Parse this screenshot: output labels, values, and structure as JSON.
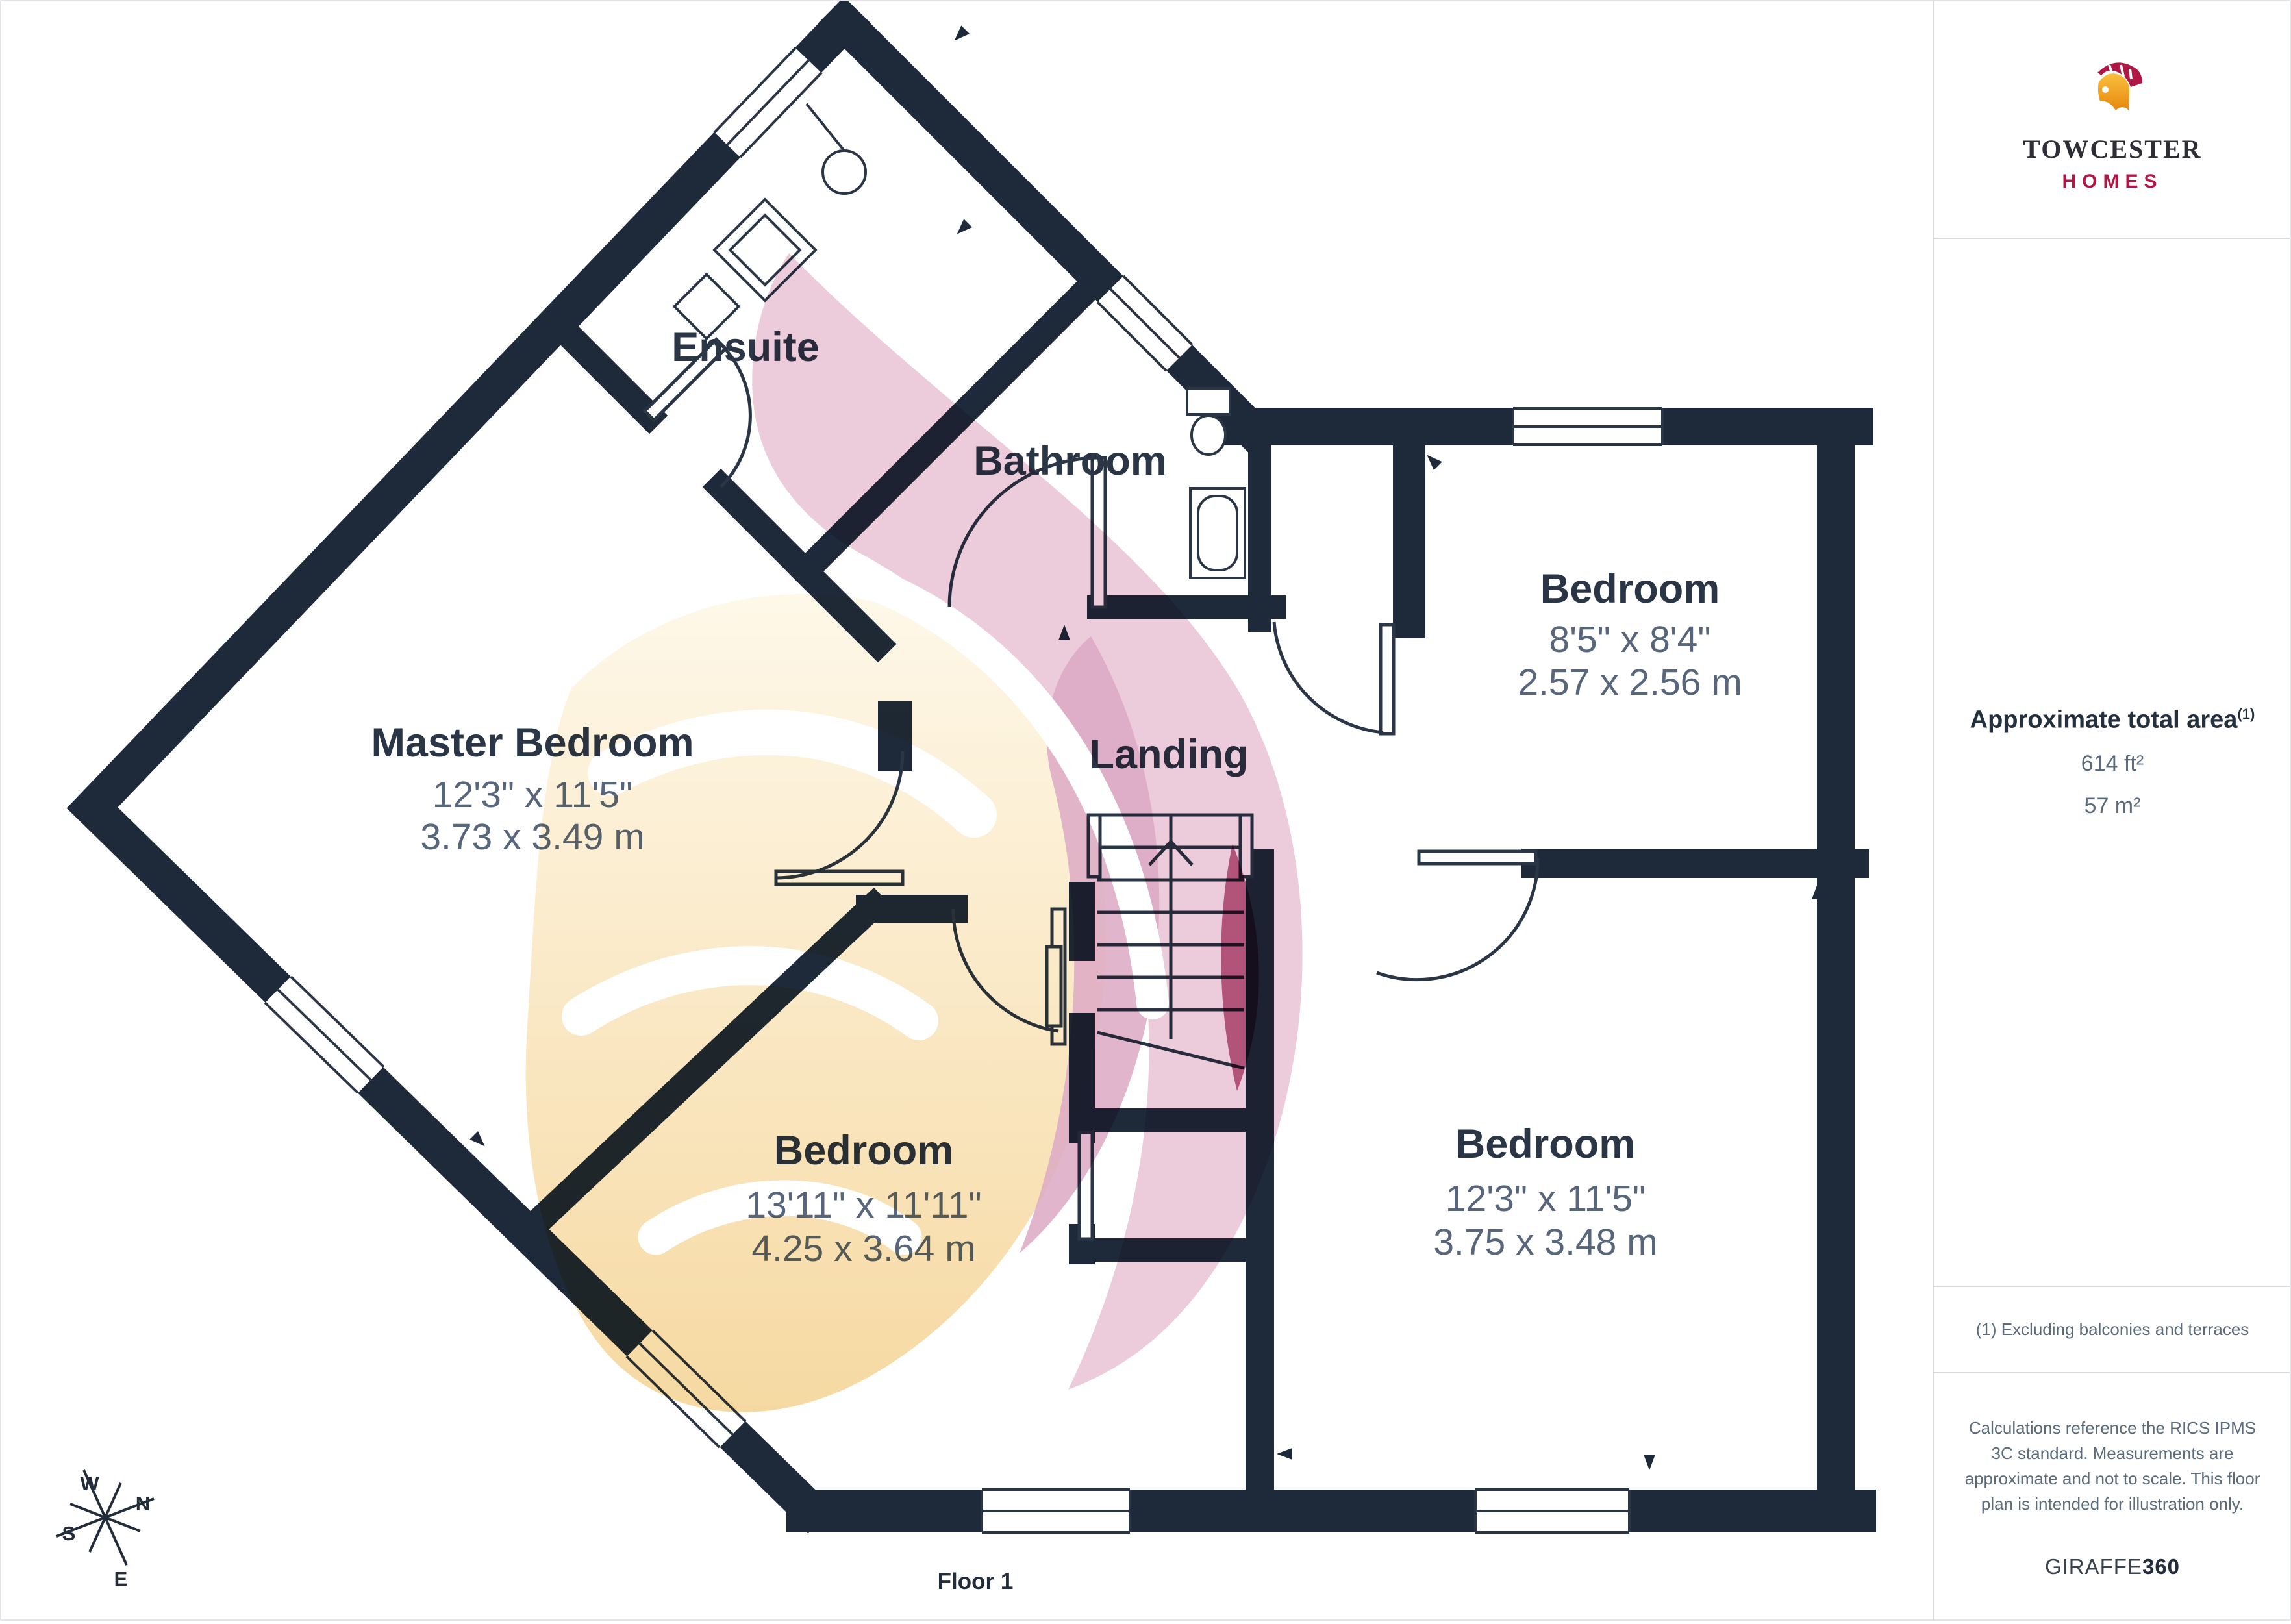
{
  "logo": {
    "brand": "TOWCESTER",
    "sub": "HOMES"
  },
  "sidebar": {
    "area_title": "Approximate total area",
    "area_sup": "(1)",
    "area_ft": "614 ft²",
    "area_m": "57 m²",
    "footnote": "(1) Excluding balconies and terraces",
    "disclaimer": "Calculations reference the RICS IPMS 3C standard. Measurements are approximate and not to scale. This floor plan is intended for illustration only.",
    "brand_regular": "GIRAFFE",
    "brand_bold": "360"
  },
  "floor": {
    "label": "Floor 1"
  },
  "compass": {
    "n": "N",
    "s": "S",
    "e": "E",
    "w": "W"
  },
  "rooms": [
    {
      "id": "master-bedroom",
      "name": "Master Bedroom",
      "imperial": "12'3\" x 11'5\"",
      "metric": "3.73 x 3.49 m"
    },
    {
      "id": "ensuite",
      "name": "Ensuite"
    },
    {
      "id": "bathroom",
      "name": "Bathroom"
    },
    {
      "id": "landing",
      "name": "Landing"
    },
    {
      "id": "bedroom-top-right",
      "name": "Bedroom",
      "imperial": "8'5\" x 8'4\"",
      "metric": "2.57 x 2.56 m"
    },
    {
      "id": "bedroom-bottom-middle",
      "name": "Bedroom",
      "imperial": "13'11\" x 11'11\"",
      "metric": "4.25 x 3.64 m"
    },
    {
      "id": "bedroom-bottom-right",
      "name": "Bedroom",
      "imperial": "12'3\" x 11'5\"",
      "metric": "3.75 x 3.48 m"
    }
  ],
  "colors": {
    "wall": "#1E2A3A",
    "room_title": "#2A3545",
    "room_dims": "#57667A",
    "sidebar_text": "#5C6B7A",
    "divider": "#D9DADC",
    "brand_crimson": "#B01745",
    "brand_orange": "#F6A21F",
    "watermark_pink": "#ECCBDA",
    "watermark_rose": "#DCA9C4",
    "watermark_cream": "#F8DCA9"
  }
}
